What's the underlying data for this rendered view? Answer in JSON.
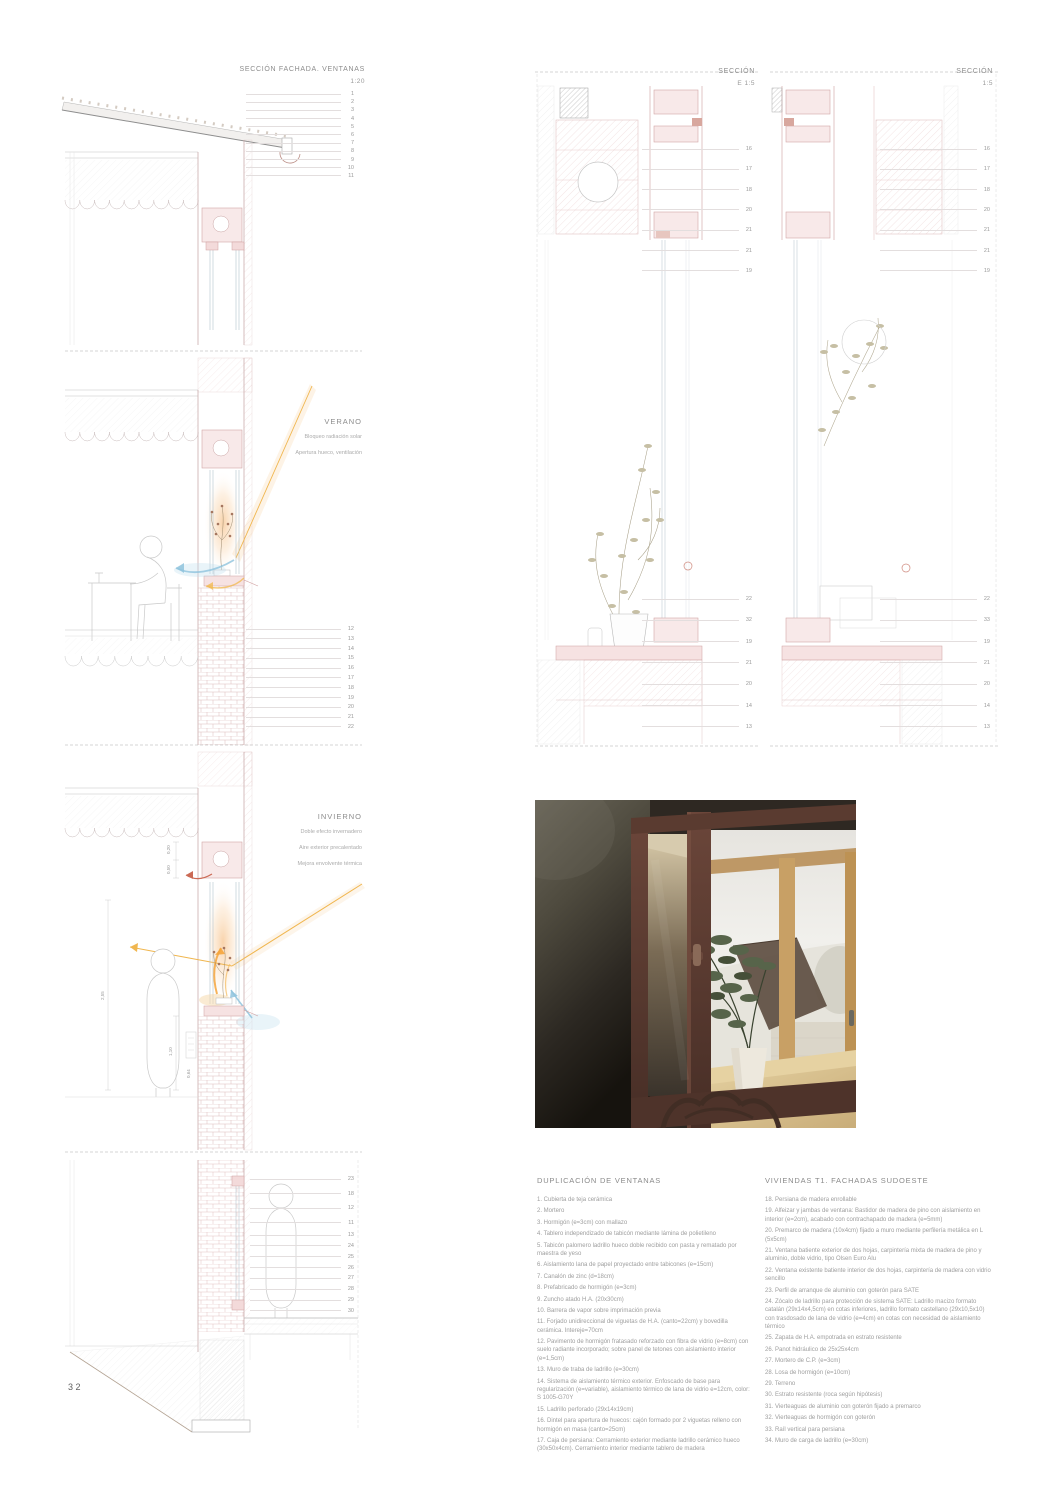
{
  "page": {
    "number": "32"
  },
  "colors": {
    "paper": "#ffffff",
    "line_gray": "#bdbdbd",
    "rose_hatch": "#dfb8b8",
    "brick_rose": "#ddbaba",
    "sun_orange": "#f0b64f",
    "glow_warm": "#f7c896",
    "cool_blue": "#8fc3dd",
    "red_accent": "#cb6a55",
    "text_gray": "#8c8c8c"
  },
  "drawings": {
    "facade_section": {
      "title": "SECCIÓN FACHADA. VENTANAS",
      "scale": "1:20",
      "callouts_top": [
        "1",
        "2",
        "3",
        "4",
        "5",
        "6",
        "7",
        "8",
        "9",
        "10",
        "11"
      ],
      "callouts_mid": [
        "12",
        "13",
        "14",
        "15",
        "16",
        "17",
        "18",
        "19",
        "20",
        "21",
        "22"
      ],
      "callouts_bottom_a": [
        "23",
        "18",
        "12",
        "11"
      ],
      "callouts_bottom_b": [
        "13",
        "24",
        "25",
        "26",
        "27",
        "28",
        "29",
        "30"
      ]
    },
    "verano": {
      "title": "VERANO",
      "notes": [
        "Bloqueo radiación solar",
        "Apertura hueco, ventilación"
      ]
    },
    "invierno": {
      "title": "INVIERNO",
      "notes": [
        "Doble efecto invernadero",
        "Aire exterior precalentado",
        "Mejora envolvente térmica"
      ],
      "dims": [
        "0,20",
        "0,50",
        "2,55",
        "1,10",
        "0,64"
      ]
    },
    "detail_e": {
      "title": "SECCIÓN",
      "scale": "E 1:5",
      "callouts_top": [
        "16",
        "17",
        "18",
        "20",
        "21",
        "21",
        "19"
      ],
      "callouts_bottom": [
        "22",
        "32",
        "19",
        "21",
        "20",
        "14",
        "13"
      ]
    },
    "detail_r": {
      "title": "SECCIÓN",
      "scale": "1:5",
      "callouts_top": [
        "16",
        "17",
        "18",
        "20",
        "21",
        "21",
        "19"
      ],
      "callouts_bottom": [
        "22",
        "33",
        "19",
        "21",
        "20",
        "14",
        "13"
      ]
    }
  },
  "legend_left": {
    "title": "DUPLICACIÓN DE VENTANAS",
    "items": [
      "1. Cubierta de teja cerámica",
      "2. Mortero",
      "3. Hormigón (e=3cm) con mallazo",
      "4. Tablero independizado de tabicón mediante lámina de polietileno",
      "5. Tabicón palomero ladrillo hueco doble recibido con pasta y rematado por maestra de yeso",
      "6. Aislamiento lana de papel proyectado entre tabicones (e=15cm)",
      "7. Canalón de zinc (d=18cm)",
      "8. Prefabricado de hormigón (e=3cm)",
      "9. Zuncho atado H.A. (20x30cm)",
      "10. Barrera de vapor sobre imprimación previa",
      "11. Forjado unidireccional de viguetas de H.A. (canto=22cm) y bovedilla cerámica. Intereje=70cm",
      "12. Pavimento de hormigón fratasado reforzado con fibra de vidrio (e=8cm) con suelo radiante incorporado; sobre panel de tetones con aislamiento interior (e=1,5cm)",
      "13. Muro de traba de ladrillo (e=30cm)",
      "14. Sistema de aislamiento térmico exterior. Enfoscado de base para regularización (e=variable), aislamiento térmico de lana de vidrio e=12cm, color: S 1005-G70Y",
      "15. Ladrillo perforado (29x14x19cm)",
      "16. Dintel para apertura de huecos: cajón formado por 2 viguetas relleno con hormigón en masa (canto=25cm)",
      "17. Caja de persiana: Cerramiento exterior mediante ladrillo cerámico hueco (30x50x4cm). Cerramiento interior mediante tablero de madera"
    ]
  },
  "legend_right": {
    "title": "VIVIENDAS T1. FACHADAS SUDOESTE",
    "items": [
      "18. Persiana de madera enrollable",
      "19. Alfeizar y jambas de ventana: Bastidor de madera de pino con aislamiento en interior (e=2cm), acabado con contrachapado de madera (e=5mm)",
      "20. Premarco de madera (10x4cm) fijado a muro mediante perfilería metálica en L (5x5cm)",
      "21. Ventana batiente exterior de dos hojas, carpintería mixta de madera de pino y aluminio, doble vidrio, tipo Olsen Euro Alu",
      "22. Ventana existente batiente interior de dos hojas, carpintería de madera con vidrio sencillo",
      "23. Perfil de arranque de aluminio con goterón para SATE",
      "24. Zócalo de ladrillo para protección de sistema SATE: Ladrillo macizo formato catalán (29x14x4,5cm) en cotas inferiores, ladrillo formato castellano (29x10,5x10) con trasdosado de lana de vidrio (e=4cm) en cotas con necesidad de aislamiento térmico",
      "25. Zapata de H.A. empotrada en estrato resistente",
      "26. Panot hidráulico de 25x25x4cm",
      "27. Mortero de C.P. (e=3cm)",
      "28. Losa de hormigón (e=10cm)",
      "29. Terreno",
      "30. Estrato resistente (roca según hipótesis)",
      "31. Vierteaguas de aluminio con goterón fijado a premarco",
      "32. Vierteaguas de hormigón con goterón",
      "33. Raíl vertical para persiana",
      "34. Muro de carga de ladrillo (e=30cm)"
    ]
  }
}
